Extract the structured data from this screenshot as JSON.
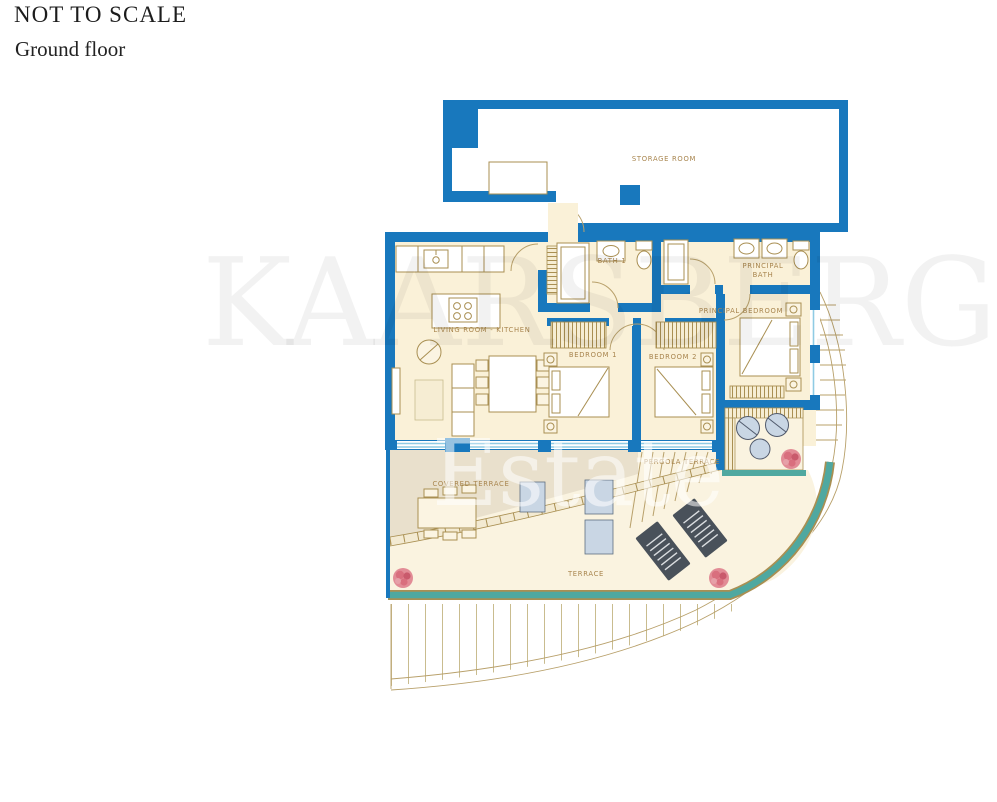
{
  "header": {
    "title": "NOT TO SCALE",
    "subtitle": "Ground floor"
  },
  "watermark": {
    "line1": "KAARSBERG",
    "line2": "Estate"
  },
  "rooms": {
    "storage": "STORAGE ROOM",
    "bath1": "BATH 1",
    "principal_bath_l1": "PRINCIPAL",
    "principal_bath_l2": "BATH",
    "principal_bedroom": "PRINCIPAL BEDROOM",
    "living_kitchen": "LIVING ROOM - KITCHEN",
    "bedroom1": "BEDROOM 1",
    "bedroom2": "BEDROOM 2",
    "covered_terrace": "COVERED TERRACE",
    "pergola_terrace": "PERGOLA TERRACE",
    "terrace": "TERRACE"
  },
  "colors": {
    "wall_blue": "#1878BD",
    "floor_cream": "#FAF1D8",
    "terrace_cream": "#FAF3E0",
    "shade_beige": "#E9E0CC",
    "label_tan": "#A8854E",
    "furniture_tan": "#A98F52",
    "teal_edge": "#4FA8A0",
    "glass_blue": "#8FCBE4",
    "lounger_dark": "#49515A",
    "seat_blue": "#C9D6E4",
    "plant_pink": "#DF6F7D"
  }
}
